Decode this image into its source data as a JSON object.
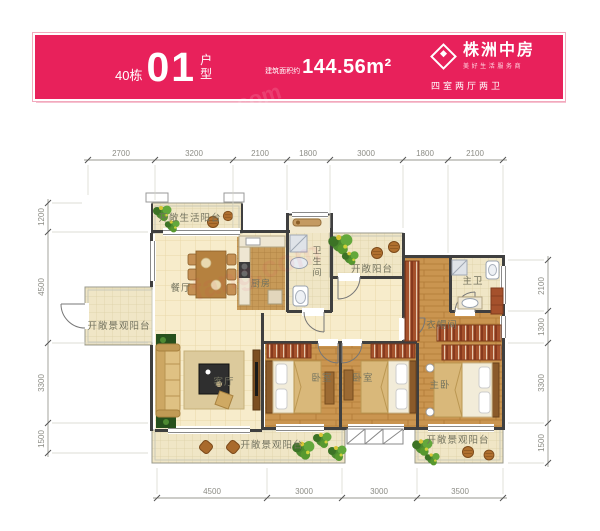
{
  "header": {
    "building": "40栋",
    "unit_number": "01",
    "unit_suffix": "户型",
    "area_prefix": "建筑面积约",
    "area_value": "144.56m²",
    "brand": "株洲中房",
    "brand_slogan": "美好生活服务商",
    "layout_badge": "四室两厅两卫",
    "bg_color": "#e8215b"
  },
  "watermark": {
    "text": "fang.com"
  },
  "dimensions": {
    "top": [
      "2700",
      "3200",
      "2100",
      "1800",
      "3000",
      "1800",
      "2100"
    ],
    "left": [
      "1200",
      "4500",
      "3300",
      "1500"
    ],
    "right": [
      "2100",
      "1300",
      "3300",
      "1500"
    ],
    "bottom": [
      "4500",
      "3000",
      "3000",
      "3500"
    ]
  },
  "rooms": {
    "life_balcony": "开敞生活阳台",
    "dining": "餐厅",
    "kitchen": "厨房",
    "bathroom": "卫生间",
    "open_balcony": "开敞阳台",
    "master_bath": "主卫",
    "closet": "衣帽间",
    "view_balcony_left": "开敞景观阳台",
    "living": "客厅",
    "bedroom1": "卧室",
    "bedroom2": "卧室",
    "master_bedroom": "主卧",
    "view_balcony_bottom": "开敞景观阳台",
    "view_balcony_right": "开敞景观阳台"
  }
}
